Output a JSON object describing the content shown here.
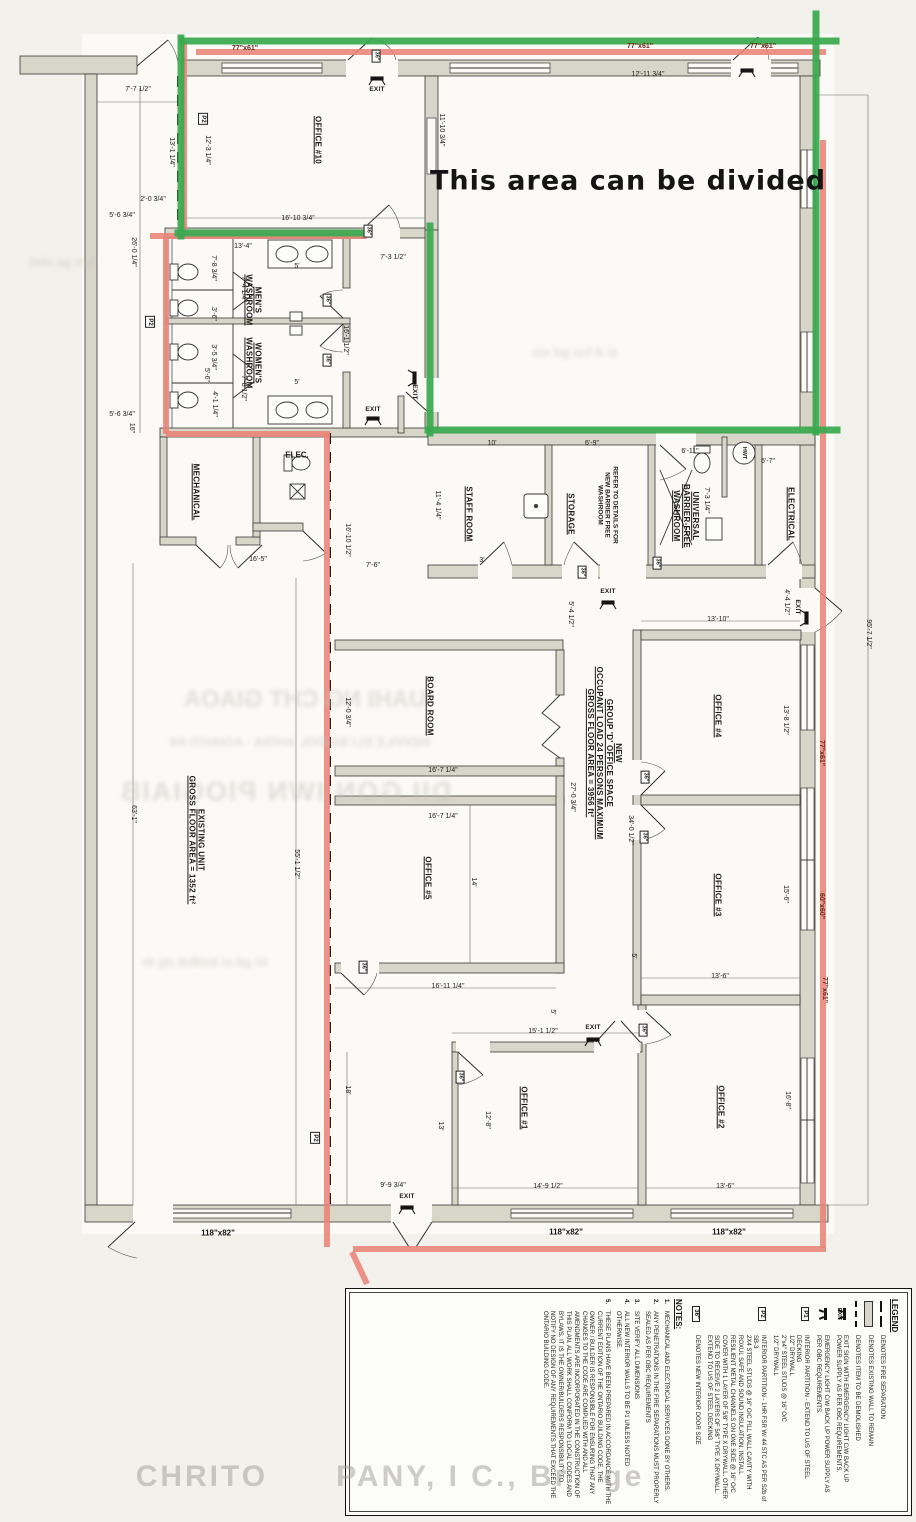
{
  "annotations": {
    "divided_note": "This area can be divided",
    "watermark": "CHRITO      PANY, I C., Br   ge"
  },
  "artifacts": {
    "bleed": [
      {
        "t": "UAHI NG CHT GIAOA",
        "x": 305,
        "y": 700,
        "c": "b1"
      },
      {
        "t": "INDIVILE ELI BAIDOL AHOIA - AOIAHTI IHI",
        "x": 300,
        "y": 742,
        "c": "b2"
      },
      {
        "t": "DII GON IWN PIOGIAIB",
        "x": 285,
        "y": 792,
        "c": "b3"
      },
      {
        "t": "ht gd ei bstBdl dg th",
        "x": 205,
        "y": 962,
        "c": "b2"
      },
      {
        "t": "ei d hsi gd eis",
        "x": 575,
        "y": 352,
        "c": "b2"
      },
      {
        "t": "lyn ga ehd",
        "x": 62,
        "y": 262,
        "c": "b2"
      }
    ]
  },
  "plan": {
    "labels": [
      {
        "t": "OFFICE #10",
        "x": 318,
        "y": 140,
        "r": 90,
        "c": "rm"
      },
      {
        "t": "MEN'S\nWASHROOM",
        "x": 253,
        "y": 300,
        "r": 90,
        "c": "rm"
      },
      {
        "t": "WOMEN'S\nWASHROOM",
        "x": 253,
        "y": 363,
        "r": 90,
        "c": "rm"
      },
      {
        "t": "MECHANICAL",
        "x": 196,
        "y": 492,
        "r": 90,
        "c": "rm"
      },
      {
        "t": "ELEC.",
        "x": 297,
        "y": 455,
        "r": 0,
        "c": "rm2"
      },
      {
        "t": "STAFF ROOM",
        "x": 469,
        "y": 514,
        "r": 90,
        "c": "rm"
      },
      {
        "t": "STORAGE",
        "x": 571,
        "y": 514,
        "r": 90,
        "c": "rm"
      },
      {
        "t": "REFER TO DETAILS FOR\nNEW BARRIER FREE\nWASHROOM",
        "x": 607,
        "y": 505,
        "r": 90,
        "c": "ref"
      },
      {
        "t": "UNIVERSAL\nBARRIER-FREE\nWASHROOM",
        "x": 686,
        "y": 516,
        "r": 90,
        "c": "rm"
      },
      {
        "t": "ELECTRICAL",
        "x": 791,
        "y": 514,
        "r": 90,
        "c": "rm"
      },
      {
        "t": "HWT",
        "x": 744,
        "y": 453,
        "r": 90,
        "c": "tiny"
      },
      {
        "t": "BOARD ROOM",
        "x": 430,
        "y": 706,
        "r": 90,
        "c": "rm"
      },
      {
        "t": "OFFICE #5",
        "x": 428,
        "y": 878,
        "r": 90,
        "c": "rm"
      },
      {
        "t": "OFFICE #4",
        "x": 718,
        "y": 716,
        "r": 90,
        "c": "rm"
      },
      {
        "t": "OFFICE #3",
        "x": 718,
        "y": 895,
        "r": 90,
        "c": "rm"
      },
      {
        "t": "OFFICE #2",
        "x": 721,
        "y": 1107,
        "r": 90,
        "c": "rm"
      },
      {
        "t": "OFFICE #1",
        "x": 524,
        "y": 1108,
        "r": 90,
        "c": "rm"
      },
      {
        "t": "EXISTING UNIT\nGROSS FLOOR AREA = 1352 ft²",
        "x": 196,
        "y": 840,
        "r": 90,
        "c": "rm"
      },
      {
        "t": "NEW\nGROUP 'D' OFFICE SPACE\nOCCUPANT LOAD 24 PERSONS MAXIMUM\nGROSS FLOOR AREA = 3956 ft²",
        "x": 604,
        "y": 753,
        "r": 90,
        "c": "rm"
      },
      {
        "t": "7'-7 1/2\"",
        "x": 138,
        "y": 90,
        "r": 0,
        "c": "dim"
      },
      {
        "t": "13'-1 1/4\"",
        "x": 171,
        "y": 152,
        "r": 90,
        "c": "dim"
      },
      {
        "t": "12'-3 1/4\"",
        "x": 207,
        "y": 150,
        "r": 90,
        "c": "dim"
      },
      {
        "t": "2'-0 3/4\"",
        "x": 153,
        "y": 200,
        "r": 0,
        "c": "dim"
      },
      {
        "t": "5'-6 3/4\"",
        "x": 122,
        "y": 216,
        "r": 0,
        "c": "dim"
      },
      {
        "t": "26'-0 1/4\"",
        "x": 133,
        "y": 252,
        "r": 90,
        "c": "dim"
      },
      {
        "t": "16'-10 3/4\"",
        "x": 298,
        "y": 219,
        "r": 0,
        "c": "dim"
      },
      {
        "t": "11'-10 3/4\"",
        "x": 441,
        "y": 130,
        "r": 90,
        "c": "dim"
      },
      {
        "t": "12'-11 3/4\"",
        "x": 648,
        "y": 75,
        "r": 0,
        "c": "dim"
      },
      {
        "t": "13'-4\"",
        "x": 243,
        "y": 247,
        "r": 0,
        "c": "dim"
      },
      {
        "t": "7'-3 1/2\"",
        "x": 393,
        "y": 258,
        "r": 0,
        "c": "dim"
      },
      {
        "t": "7'-8 3/4\"",
        "x": 213,
        "y": 268,
        "r": 90,
        "c": "dim"
      },
      {
        "t": "7'-4 1/4\"",
        "x": 243,
        "y": 289,
        "r": 90,
        "c": "dim"
      },
      {
        "t": "5'",
        "x": 297,
        "y": 267,
        "r": 0,
        "c": "dim"
      },
      {
        "t": "3'-6\"",
        "x": 213,
        "y": 314,
        "r": 90,
        "c": "dim"
      },
      {
        "t": "16'-1 1/2\"",
        "x": 345,
        "y": 340,
        "r": 90,
        "c": "dim"
      },
      {
        "t": "3'-5 3/4\"",
        "x": 213,
        "y": 357,
        "r": 90,
        "c": "dim"
      },
      {
        "t": "5'-6\"",
        "x": 206,
        "y": 375,
        "r": 90,
        "c": "dim"
      },
      {
        "t": "7'-8 1/2\"",
        "x": 243,
        "y": 388,
        "r": 90,
        "c": "dim"
      },
      {
        "t": "4'-1 1/4\"",
        "x": 214,
        "y": 404,
        "r": 90,
        "c": "dim"
      },
      {
        "t": "5'",
        "x": 297,
        "y": 383,
        "r": 0,
        "c": "dim"
      },
      {
        "t": "5'-6 3/4\"",
        "x": 122,
        "y": 415,
        "r": 0,
        "c": "dim"
      },
      {
        "t": "16\"",
        "x": 131,
        "y": 428,
        "r": 90,
        "c": "dim"
      },
      {
        "t": "16'-5\"",
        "x": 258,
        "y": 560,
        "r": 0,
        "c": "dim"
      },
      {
        "t": "16'-10 1/2\"",
        "x": 347,
        "y": 540,
        "r": 90,
        "c": "dim"
      },
      {
        "t": "7'-6\"",
        "x": 373,
        "y": 566,
        "r": 0,
        "c": "dim"
      },
      {
        "t": "10'",
        "x": 492,
        "y": 444,
        "r": 0,
        "c": "dim"
      },
      {
        "t": "6'-9\"",
        "x": 592,
        "y": 444,
        "r": 0,
        "c": "dim"
      },
      {
        "t": "11'-4 1/4\"",
        "x": 437,
        "y": 505,
        "r": 90,
        "c": "dim"
      },
      {
        "t": "6'-11\"",
        "x": 690,
        "y": 452,
        "r": 0,
        "c": "dim"
      },
      {
        "t": "6'-7\"",
        "x": 768,
        "y": 462,
        "r": 0,
        "c": "dim"
      },
      {
        "t": "7'-3 1/4\"",
        "x": 706,
        "y": 500,
        "r": 90,
        "c": "dim"
      },
      {
        "t": "3'",
        "x": 482,
        "y": 561,
        "r": 0,
        "c": "dim"
      },
      {
        "t": "5'-4 1/2\"",
        "x": 570,
        "y": 614,
        "r": 90,
        "c": "dim"
      },
      {
        "t": "4'-4 1/2\"",
        "x": 786,
        "y": 602,
        "r": 90,
        "c": "dim"
      },
      {
        "t": "13'-10\"",
        "x": 718,
        "y": 620,
        "r": 0,
        "c": "dim"
      },
      {
        "t": "12'-0 3/4\"",
        "x": 347,
        "y": 712,
        "r": 90,
        "c": "dim"
      },
      {
        "t": "16'-7 1/4\"",
        "x": 443,
        "y": 771,
        "r": 0,
        "c": "dim"
      },
      {
        "t": "16'-7 1/4\"",
        "x": 443,
        "y": 817,
        "r": 0,
        "c": "dim"
      },
      {
        "t": "27'-0 3/4\"",
        "x": 572,
        "y": 797,
        "r": 90,
        "c": "dim"
      },
      {
        "t": "34'-0 1/2\"",
        "x": 630,
        "y": 830,
        "r": 90,
        "c": "dim"
      },
      {
        "t": "13'-8 1/2\"",
        "x": 785,
        "y": 720,
        "r": 90,
        "c": "dim"
      },
      {
        "t": "14'",
        "x": 473,
        "y": 882,
        "r": 90,
        "c": "dim"
      },
      {
        "t": "15'-6\"",
        "x": 785,
        "y": 894,
        "r": 90,
        "c": "dim"
      },
      {
        "t": "16'-11 1/4\"",
        "x": 448,
        "y": 987,
        "r": 0,
        "c": "dim"
      },
      {
        "t": "13'-6\"",
        "x": 720,
        "y": 977,
        "r": 0,
        "c": "dim"
      },
      {
        "t": "63'-1\"",
        "x": 133,
        "y": 814,
        "r": 90,
        "c": "dim"
      },
      {
        "t": "55'-1 1/2\"",
        "x": 296,
        "y": 864,
        "r": 90,
        "c": "dim"
      },
      {
        "t": "95'-7 1/2\"",
        "x": 868,
        "y": 634,
        "r": 90,
        "c": "dim"
      },
      {
        "t": "18'",
        "x": 347,
        "y": 1090,
        "r": 90,
        "c": "dim"
      },
      {
        "t": "15'-1 1/2\"",
        "x": 543,
        "y": 1032,
        "r": 0,
        "c": "dim"
      },
      {
        "t": "5'",
        "x": 552,
        "y": 1012,
        "r": 90,
        "c": "dim"
      },
      {
        "t": "5'",
        "x": 633,
        "y": 956,
        "r": 90,
        "c": "dim"
      },
      {
        "t": "13'",
        "x": 440,
        "y": 1126,
        "r": 90,
        "c": "dim"
      },
      {
        "t": "12'-8\"",
        "x": 487,
        "y": 1120,
        "r": 90,
        "c": "dim"
      },
      {
        "t": "16'-8\"",
        "x": 787,
        "y": 1100,
        "r": 90,
        "c": "dim"
      },
      {
        "t": "14'-9 1/2\"",
        "x": 548,
        "y": 1187,
        "r": 0,
        "c": "dim"
      },
      {
        "t": "13'-6\"",
        "x": 725,
        "y": 1187,
        "r": 0,
        "c": "dim"
      },
      {
        "t": "9'-9 3/4\"",
        "x": 393,
        "y": 1186,
        "r": 0,
        "c": "dim"
      },
      {
        "t": "118\"x82\"",
        "x": 218,
        "y": 1233,
        "r": 0,
        "c": "win2"
      },
      {
        "t": "118\"x82\"",
        "x": 566,
        "y": 1232,
        "r": 0,
        "c": "win2"
      },
      {
        "t": "118\"x82\"",
        "x": 729,
        "y": 1232,
        "r": 0,
        "c": "win2"
      },
      {
        "t": "77\"x61\"",
        "x": 245,
        "y": 49,
        "r": 0,
        "c": "win"
      },
      {
        "t": "77\"x61\"",
        "x": 640,
        "y": 47,
        "r": 0,
        "c": "win"
      },
      {
        "t": "77\"x61\"",
        "x": 763,
        "y": 47,
        "r": 0,
        "c": "win"
      },
      {
        "t": "77\"x61\"",
        "x": 821,
        "y": 753,
        "r": 90,
        "c": "win"
      },
      {
        "t": "60\"x60\"",
        "x": 821,
        "y": 906,
        "r": 90,
        "c": "win"
      },
      {
        "t": "77\"x61\"",
        "x": 824,
        "y": 990,
        "r": 90,
        "c": "win"
      },
      {
        "t": "EXIT",
        "x": 377,
        "y": 90,
        "r": 0,
        "c": "exitl"
      },
      {
        "t": "EXIT",
        "x": 373,
        "y": 410,
        "r": 0,
        "c": "exitl"
      },
      {
        "t": "EXIT",
        "x": 414,
        "y": 392,
        "r": 90,
        "c": "exitl"
      },
      {
        "t": "EXIT",
        "x": 608,
        "y": 592,
        "r": 0,
        "c": "exitl"
      },
      {
        "t": "EXIT",
        "x": 797,
        "y": 607,
        "r": 90,
        "c": "exitl"
      },
      {
        "t": "EXIT",
        "x": 593,
        "y": 1028,
        "r": 0,
        "c": "exitl"
      },
      {
        "t": "EXIT",
        "x": 407,
        "y": 1197,
        "r": 0,
        "c": "exitl"
      },
      {
        "t": "36\"",
        "x": 376,
        "y": 56,
        "r": 90,
        "c": "box36"
      },
      {
        "t": "36\"",
        "x": 368,
        "y": 231,
        "r": 90,
        "c": "box36"
      },
      {
        "t": "36\"",
        "x": 327,
        "y": 300,
        "r": 90,
        "c": "box36"
      },
      {
        "t": "36\"",
        "x": 327,
        "y": 360,
        "r": 90,
        "c": "box36"
      },
      {
        "t": "36\"",
        "x": 582,
        "y": 572,
        "r": 90,
        "c": "box36"
      },
      {
        "t": "36\"",
        "x": 657,
        "y": 563,
        "r": 90,
        "c": "box36"
      },
      {
        "t": "36\"",
        "x": 645,
        "y": 777,
        "r": 90,
        "c": "box36"
      },
      {
        "t": "36\"",
        "x": 644,
        "y": 837,
        "r": 90,
        "c": "box36"
      },
      {
        "t": "36\"",
        "x": 363,
        "y": 967,
        "r": 90,
        "c": "box36"
      },
      {
        "t": "36\"",
        "x": 460,
        "y": 1077,
        "r": 90,
        "c": "box36"
      },
      {
        "t": "36\"",
        "x": 643,
        "y": 1030,
        "r": 90,
        "c": "box36"
      },
      {
        "t": "P2",
        "x": 203,
        "y": 119,
        "r": 90,
        "c": "pbox"
      },
      {
        "t": "P2",
        "x": 150,
        "y": 322,
        "r": 90,
        "c": "pbox"
      },
      {
        "t": "P2",
        "x": 315,
        "y": 1138,
        "r": 90,
        "c": "pbox"
      }
    ]
  },
  "legend": {
    "title": "LEGEND",
    "items": [
      {
        "symbol": "fire",
        "sym_label": "",
        "text": "DENOTES  FIRE SEPARATION"
      },
      {
        "symbol": "wall",
        "sym_label": "",
        "text": "DENOTES EXISTING WALL TO REMAIN"
      },
      {
        "symbol": "demo",
        "sym_label": "",
        "text": "DENOTES ITEM TO BE DEMOLISHED"
      },
      {
        "symbol": "exit",
        "sym_label": "EXIT",
        "text": "EXIT SIGN WITH EMERGENCY LIGHT C/W BACK UP POWER SUPPLY AS PER OBC REQUIREMENTS."
      },
      {
        "symbol": "light",
        "sym_label": "",
        "text": "EMERGENCY LIGHT C/W BACK UP POWER SUPPLY AS PER OBC REQUIREMENTS."
      },
      {
        "symbol": "p1",
        "sym_label": "P1",
        "text": "INTERIOR PARTITION - EXTEND TO U/S OF STEEL DECKING\n1/2\" DRYWALL\n2\"x4\" STEEL STUDS @ 16\" O/C\n1/2\" DRYWALL"
      },
      {
        "symbol": "p2",
        "sym_label": "P2",
        "text": "INTERIOR PARTITION - 1HR FSR W/ 44 STC AS PER S2b of SB-3\n2X4 STEEL STUDS @ 16\" O/C FILL WALL CAVITY WITH ROXUL SAFE AND SOUND INSULATION. INSTALL RESILIENT METAL CHANNELS ON ONE SIDE @ 16\" O/C COVER WITH 1 LAYER OF 5/8\" TYPE X DRYWALL. OTHER SIDE TO RECEIVE 2 LAYERS OF 5/8\" TYPE X DRYWALL. EXTEND TO U/S OF STEEL DECKING"
      },
      {
        "symbol": "door36",
        "sym_label": "36\"",
        "text": "DENOTES NEW INTERIOR DOOR SIZE"
      }
    ],
    "notes_title": "NOTES:",
    "notes": [
      {
        "n": "1.",
        "text": "MECHANICAL AND ELECTRICAL SERVICES DONE BY OTHERS."
      },
      {
        "n": "2.",
        "text": "ANY PENETRATIONS IN THE FIRE SEPARATIONS MUST PROPERLY SEALED AS PER OBC REQUIREMENTS"
      },
      {
        "n": "3.",
        "text": "SITE VERIFY ALL DIMENSIONS"
      },
      {
        "n": "4.",
        "text": "ALL NEW INTERIOR WALLS TO BE P1 UNLESS NOTED OTHERWISE."
      },
      {
        "n": "5.",
        "text": "THESE PLANS HAVE BEEN PREPARED IN ACCORDANCE WITH THE CURRENT EDITION OF THE ONTARIO BUILDING CODE. THE OWNER / BUILDER IS RESPONSIBLE FOR ENSURING THAT ANY CHANGES TO THE CODE ARE COMPLIED WITH AND ALL AMENDMENTS ARE INCORPORATED IN THE CONSTRUCTION OF THIS PLAN. ALL WORK SHALL CONFORM TO LOCAL CODES AND BYLAWS. IT IS THE OWNER/BUILDERS RESPONSIBILITY TO NOTIFY NO DESIGN OF ANY REQUIREMENTS THAT EXCEED THE ONTARIO BUILDING CODE."
      }
    ]
  },
  "colors": {
    "overlay_green": "#3aa94f",
    "overlay_red": "#ea8376",
    "wall_fill": "#d8d5c9",
    "paper": "#f2f1ec"
  }
}
